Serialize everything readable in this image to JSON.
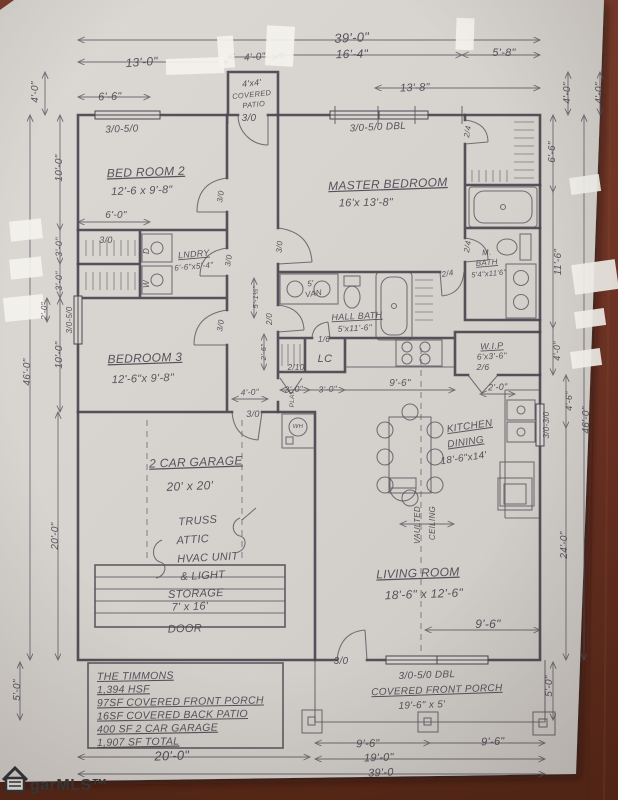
{
  "document": {
    "kind": "hand-drawn floor plan photo",
    "plan_title": "THE TIMMONS",
    "watermark": "garMLS™"
  },
  "colors": {
    "paper": "#d7d3cf",
    "wood": "#6e3323",
    "ink": "#49454f",
    "ink2": "#56525c",
    "whiteout": "#f4f2ed"
  },
  "summary_box": {
    "lines": [
      "THE TIMMONS",
      "1,394 HSF",
      "97SF COVERED FRONT PORCH",
      "16SF COVERED BACK PATIO",
      "400 SF 2 CAR GARAGE",
      "1,907 SF TOTAL"
    ]
  },
  "labels": [
    {
      "t": "39'-0\"",
      "x": 352,
      "y": 42,
      "s": 13,
      "r": -3
    },
    {
      "t": "13'-0\"",
      "x": 142,
      "y": 66,
      "s": 12,
      "r": -4
    },
    {
      "t": "4'-0\"",
      "x": 255,
      "y": 60,
      "s": 10,
      "r": -4
    },
    {
      "t": "16'-4\"",
      "x": 352,
      "y": 58,
      "s": 12,
      "r": -1
    },
    {
      "t": "5'-8\"",
      "x": 504,
      "y": 56,
      "s": 11,
      "r": 0
    },
    {
      "t": "13'-8\"",
      "x": 415,
      "y": 91,
      "s": 11,
      "r": -2
    },
    {
      "t": "6'-6\"",
      "x": 110,
      "y": 100,
      "s": 11,
      "r": -2
    },
    {
      "t": "4'x4'",
      "x": 252,
      "y": 86,
      "s": 9,
      "r": -6
    },
    {
      "t": "COVERED",
      "x": 252,
      "y": 97,
      "s": 7.5,
      "r": -6
    },
    {
      "t": "PATIO",
      "x": 254,
      "y": 107,
      "s": 7.5,
      "r": -6
    },
    {
      "t": "3/0",
      "x": 249,
      "y": 121,
      "s": 10,
      "r": 0
    },
    {
      "t": "3/0-5/0",
      "x": 122,
      "y": 132,
      "s": 10,
      "r": -2
    },
    {
      "t": "3/0-5/0 DBL",
      "x": 378,
      "y": 130,
      "s": 10,
      "r": -3
    },
    {
      "t": "4'-0\"",
      "x": 38,
      "y": 92,
      "s": 10,
      "r": -90
    },
    {
      "t": "10'-0\"",
      "x": 62,
      "y": 168,
      "s": 10,
      "r": -90
    },
    {
      "t": "3'-0\"",
      "x": 62,
      "y": 247,
      "s": 9,
      "r": -90
    },
    {
      "t": "3'-0\"",
      "x": 62,
      "y": 281,
      "s": 9,
      "r": -90
    },
    {
      "t": "2'-0\"",
      "x": 47,
      "y": 311,
      "s": 8,
      "r": -90
    },
    {
      "t": "10'-0\"",
      "x": 62,
      "y": 355,
      "s": 10,
      "r": -90
    },
    {
      "t": "46'-0\"",
      "x": 30,
      "y": 372,
      "s": 10,
      "r": -90
    },
    {
      "t": "20'-0\"",
      "x": 58,
      "y": 536,
      "s": 10,
      "r": -90
    },
    {
      "t": "5'-0\"",
      "x": 20,
      "y": 690,
      "s": 10,
      "r": -90
    },
    {
      "t": "4'-0\"",
      "x": 570,
      "y": 93,
      "s": 10,
      "r": -90
    },
    {
      "t": "4'-0\"",
      "x": 602,
      "y": 93,
      "s": 10,
      "r": -90
    },
    {
      "t": "6'-6\"",
      "x": 555,
      "y": 152,
      "s": 10,
      "r": -90
    },
    {
      "t": "11'-6\"",
      "x": 561,
      "y": 262,
      "s": 10,
      "r": -90
    },
    {
      "t": "4'-0\"",
      "x": 560,
      "y": 351,
      "s": 9,
      "r": -90
    },
    {
      "t": "4'-6\"",
      "x": 572,
      "y": 401,
      "s": 9,
      "r": -90
    },
    {
      "t": "3/0-3/0",
      "x": 549,
      "y": 425,
      "s": 8,
      "r": -90
    },
    {
      "t": "46'-0\"",
      "x": 589,
      "y": 420,
      "s": 10,
      "r": -90
    },
    {
      "t": "24'-0\"",
      "x": 567,
      "y": 545,
      "s": 10,
      "r": -90
    },
    {
      "t": "5'-0\"",
      "x": 552,
      "y": 686,
      "s": 10,
      "r": -90
    },
    {
      "t": "BED ROOM 2",
      "x": 146,
      "y": 176,
      "s": 12,
      "r": -2,
      "u": 1
    },
    {
      "t": "12'-6 x 9'-8\"",
      "x": 142,
      "y": 194,
      "s": 11,
      "r": -2
    },
    {
      "t": "6'-0\"",
      "x": 116,
      "y": 218,
      "s": 10,
      "r": 0
    },
    {
      "t": "3/0",
      "x": 106,
      "y": 243,
      "s": 9,
      "r": 0
    },
    {
      "t": "D",
      "x": 149,
      "y": 251,
      "s": 8,
      "r": -90
    },
    {
      "t": "W",
      "x": 149,
      "y": 284,
      "s": 8,
      "r": -90
    },
    {
      "t": "LNDRY",
      "x": 194,
      "y": 257,
      "s": 9,
      "r": -5,
      "u": 1
    },
    {
      "t": "6'-6\"x5'-4\"",
      "x": 194,
      "y": 269,
      "s": 8,
      "r": -5
    },
    {
      "t": "3/0",
      "x": 223,
      "y": 197,
      "s": 8,
      "r": -80
    },
    {
      "t": "3/0",
      "x": 231,
      "y": 261,
      "s": 8,
      "r": -80
    },
    {
      "t": "3/0",
      "x": 223,
      "y": 326,
      "s": 8,
      "r": -80
    },
    {
      "t": "3/0-5/0",
      "x": 72,
      "y": 320,
      "s": 8,
      "r": -90
    },
    {
      "t": "BEDROOM 3",
      "x": 145,
      "y": 362,
      "s": 12,
      "r": -2,
      "u": 1
    },
    {
      "t": "12'-6\"x 9'-8\"",
      "x": 143,
      "y": 382,
      "s": 11,
      "r": -2
    },
    {
      "t": "MASTER BEDROOM",
      "x": 388,
      "y": 188,
      "s": 12,
      "r": -2,
      "u": 1
    },
    {
      "t": "16'x 13'-8\"",
      "x": 366,
      "y": 206,
      "s": 11,
      "r": -1
    },
    {
      "t": "2/4",
      "x": 470,
      "y": 132,
      "s": 8,
      "r": -80
    },
    {
      "t": "2/4",
      "x": 470,
      "y": 247,
      "s": 8,
      "r": -80
    },
    {
      "t": "2/4",
      "x": 448,
      "y": 276,
      "s": 8,
      "r": -10
    },
    {
      "t": "3/0",
      "x": 282,
      "y": 247,
      "s": 8,
      "r": -85
    },
    {
      "t": "M.",
      "x": 487,
      "y": 255,
      "s": 8,
      "r": -5
    },
    {
      "t": "BATH",
      "x": 487,
      "y": 265,
      "s": 8,
      "r": -5,
      "u": 1
    },
    {
      "t": "5'4\"x11'6\"",
      "x": 489,
      "y": 276,
      "s": 7.5,
      "r": -5
    },
    {
      "t": "HALL BATH",
      "x": 357,
      "y": 319,
      "s": 9,
      "r": -3,
      "u": 1
    },
    {
      "t": "5'x11'-6\"",
      "x": 355,
      "y": 331,
      "s": 8.5,
      "r": -3
    },
    {
      "t": "5'",
      "x": 311,
      "y": 286,
      "s": 8,
      "r": -10
    },
    {
      "t": "VAN",
      "x": 314,
      "y": 296,
      "s": 8,
      "r": -10
    },
    {
      "t": "2/0",
      "x": 272,
      "y": 319,
      "s": 8,
      "r": -90
    },
    {
      "t": "5'-1½\"",
      "x": 258,
      "y": 297,
      "s": 7.5,
      "r": -90
    },
    {
      "t": "2'-6\"",
      "x": 266,
      "y": 352,
      "s": 7.5,
      "r": -90
    },
    {
      "t": "1/6",
      "x": 324,
      "y": 342,
      "s": 8,
      "r": 0
    },
    {
      "t": "LC",
      "x": 325,
      "y": 362,
      "s": 11,
      "r": 0
    },
    {
      "t": "2/10",
      "x": 296,
      "y": 370,
      "s": 8,
      "r": 0
    },
    {
      "t": "W.I.P",
      "x": 492,
      "y": 349,
      "s": 9,
      "r": -3,
      "u": 1
    },
    {
      "t": "6'x3'-6\"",
      "x": 492,
      "y": 359,
      "s": 8.5,
      "r": -3
    },
    {
      "t": "2/6",
      "x": 483,
      "y": 370,
      "s": 8.5,
      "r": 0
    },
    {
      "t": "2'-0\"",
      "x": 498,
      "y": 390,
      "s": 9,
      "r": -3
    },
    {
      "t": "9'-6\"",
      "x": 400,
      "y": 386,
      "s": 10,
      "r": 0
    },
    {
      "t": "3'-0\"",
      "x": 294,
      "y": 392,
      "s": 8.5,
      "r": -3
    },
    {
      "t": "3'-0\"",
      "x": 328,
      "y": 392,
      "s": 8.5,
      "r": -3
    },
    {
      "t": "KITCHEN",
      "x": 470,
      "y": 429,
      "s": 10,
      "r": -8,
      "u": 1
    },
    {
      "t": "DINING",
      "x": 466,
      "y": 445,
      "s": 10,
      "r": -8,
      "u": 1
    },
    {
      "t": "18'-6\"x14'",
      "x": 464,
      "y": 461,
      "s": 10,
      "r": -8
    },
    {
      "t": "4'-0\"",
      "x": 250,
      "y": 395,
      "s": 8.5,
      "r": -3
    },
    {
      "t": "3/0",
      "x": 253,
      "y": 417,
      "s": 9,
      "r": 0
    },
    {
      "t": "PLAT",
      "x": 294,
      "y": 399,
      "s": 6.5,
      "r": -90
    },
    {
      "t": "WH",
      "x": 298,
      "y": 428,
      "s": 6,
      "r": 0
    },
    {
      "t": "2 CAR GARAGE",
      "x": 196,
      "y": 466,
      "s": 12,
      "r": -2,
      "u": 1
    },
    {
      "t": "20' x 20'",
      "x": 190,
      "y": 490,
      "s": 12,
      "r": -2
    },
    {
      "t": "TRUSS",
      "x": 198,
      "y": 524,
      "s": 11,
      "r": -4
    },
    {
      "t": "ATTIC",
      "x": 193,
      "y": 543,
      "s": 11,
      "r": -4
    },
    {
      "t": "HVAC UNIT",
      "x": 208,
      "y": 561,
      "s": 11,
      "r": -3
    },
    {
      "t": "& LIGHT",
      "x": 203,
      "y": 579,
      "s": 11,
      "r": -3
    },
    {
      "t": "STORAGE",
      "x": 196,
      "y": 597,
      "s": 11,
      "r": -2
    },
    {
      "t": "7' x 16'",
      "x": 190,
      "y": 610,
      "s": 11,
      "r": -2
    },
    {
      "t": "DOOR",
      "x": 185,
      "y": 632,
      "s": 11,
      "r": -2
    },
    {
      "t": "VAULTED",
      "x": 420,
      "y": 525,
      "s": 8,
      "r": -90
    },
    {
      "t": "CEILING",
      "x": 435,
      "y": 523,
      "s": 8,
      "r": -90
    },
    {
      "t": "LIVING ROOM",
      "x": 418,
      "y": 577,
      "s": 12,
      "r": -2,
      "u": 1
    },
    {
      "t": "18'-6\" x 12'-6\"",
      "x": 424,
      "y": 598,
      "s": 12,
      "r": -2
    },
    {
      "t": "9'-6\"",
      "x": 488,
      "y": 628,
      "s": 12,
      "r": 0
    },
    {
      "t": "3/0",
      "x": 341,
      "y": 664,
      "s": 10,
      "r": 0
    },
    {
      "t": "3/0-5/0 DBL",
      "x": 427,
      "y": 678,
      "s": 10,
      "r": -2
    },
    {
      "t": "COVERED FRONT PORCH",
      "x": 437,
      "y": 693,
      "s": 10,
      "r": -2,
      "u": 1
    },
    {
      "t": "19'-6\" x 5'",
      "x": 422,
      "y": 708,
      "s": 10,
      "r": -2
    },
    {
      "t": "9'-6\"",
      "x": 368,
      "y": 747,
      "s": 11,
      "r": -2
    },
    {
      "t": "9'-6\"",
      "x": 493,
      "y": 745,
      "s": 11,
      "r": -2
    },
    {
      "t": "19'-0\"",
      "x": 379,
      "y": 761,
      "s": 11,
      "r": -2
    },
    {
      "t": "39'-0",
      "x": 381,
      "y": 776,
      "s": 11,
      "r": -2
    },
    {
      "t": "20'-0\"",
      "x": 172,
      "y": 760,
      "s": 13,
      "r": -2
    }
  ]
}
